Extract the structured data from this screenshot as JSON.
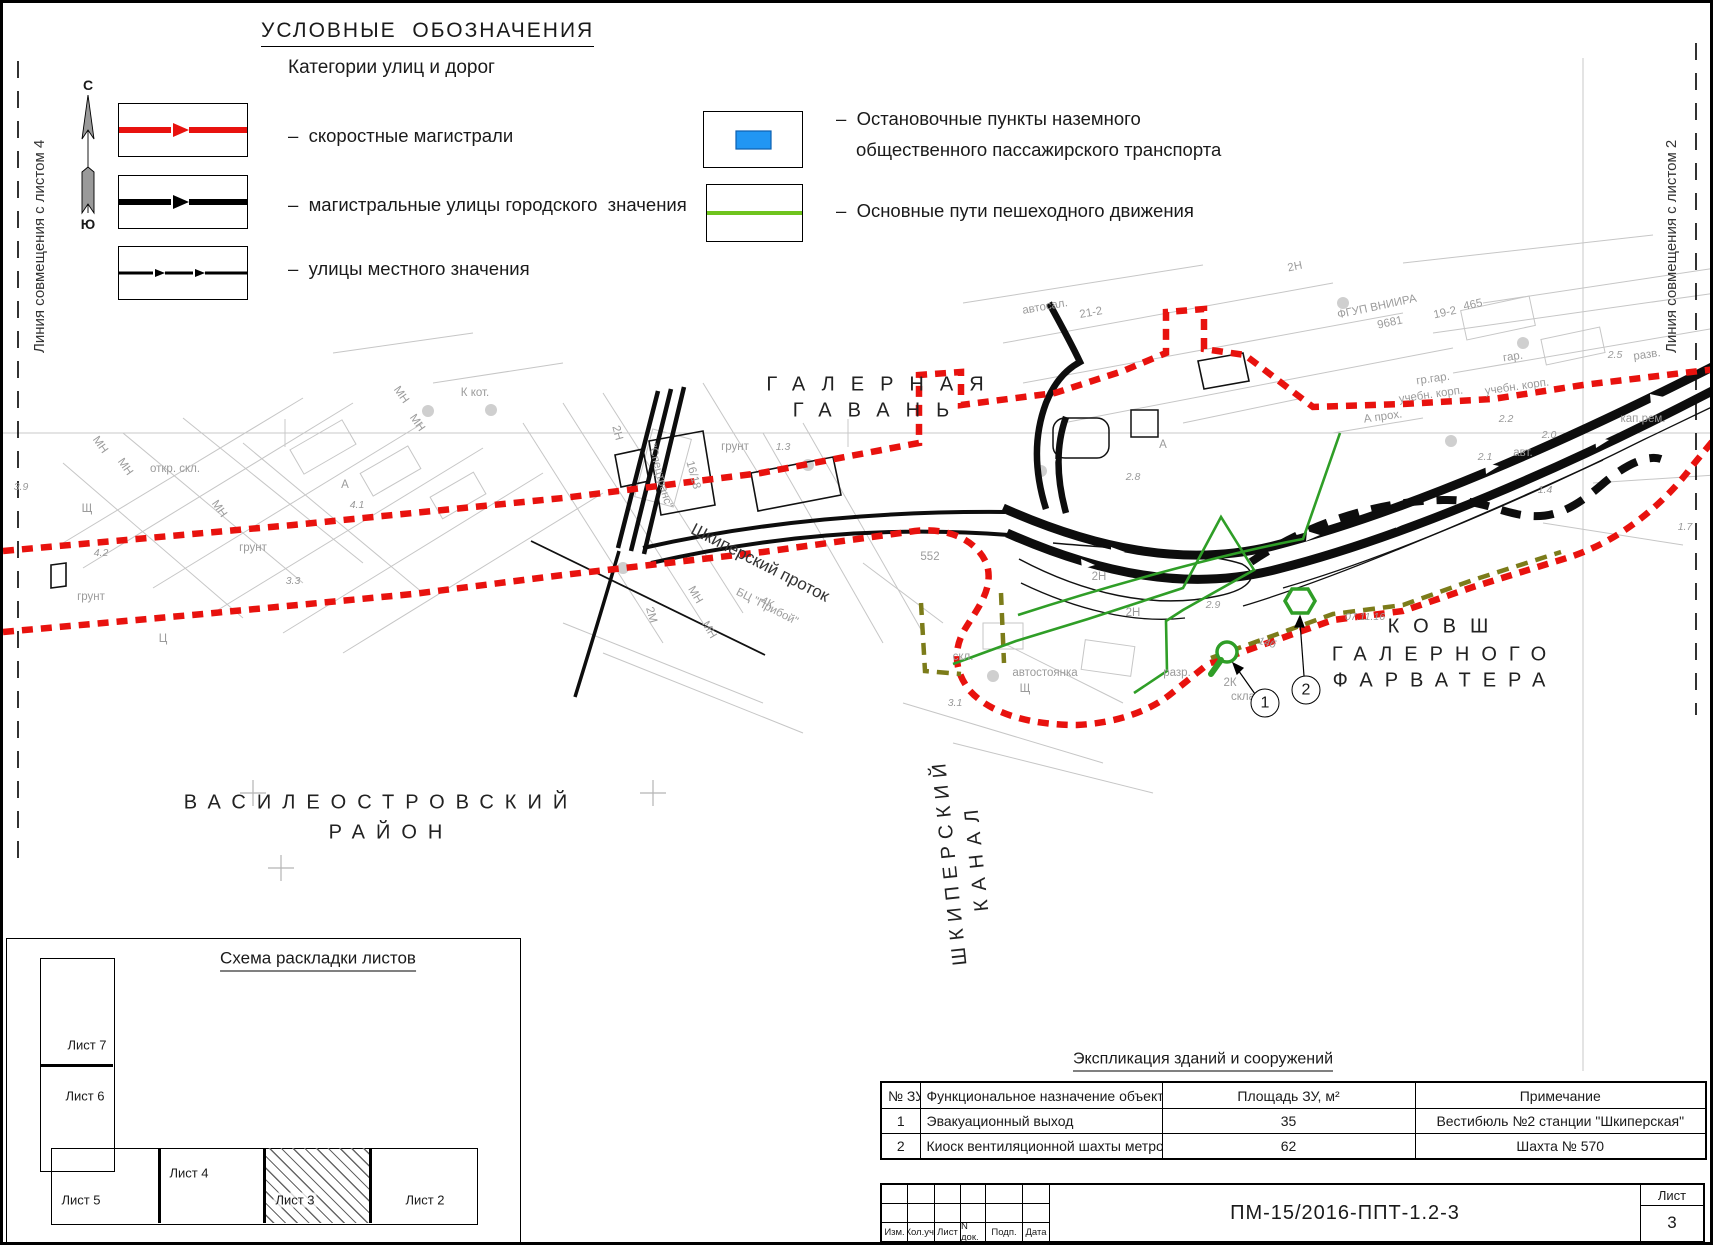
{
  "legend": {
    "title": "УСЛОВНЫЕ  ОБОЗНАЧЕНИЯ",
    "subtitle": "Категории улиц и дорог",
    "items": [
      {
        "label": "–  скоростные магистрали",
        "type": "red-line"
      },
      {
        "label": "–  магистральные улицы городского  значения",
        "type": "black-line"
      },
      {
        "label": "–  улицы местного значения",
        "type": "thin-dash-line"
      },
      {
        "label": "–  Остановочные пункты наземного общественного пассажирского транспорта",
        "type": "blue-rect"
      },
      {
        "label": "–  Основные пути пешеходного движения",
        "type": "green-line"
      }
    ],
    "colors": {
      "red": "#e8120e",
      "black": "#000000",
      "blue": "#2196f3",
      "legend_green": "#6fc41e",
      "map_green": "#2f9e27",
      "olive": "#7c7c1a"
    }
  },
  "compass": {
    "north": "С",
    "south": "Ю"
  },
  "edges": {
    "left": "Линия совмещения с листом 4",
    "right": "Линия совмещения с листом 2"
  },
  "map_labels": [
    {
      "t": "ГАЛЕРНАЯ",
      "x": 880,
      "y": 382,
      "c": "big",
      "ls": 16
    },
    {
      "t": "ГАВАНЬ",
      "x": 876,
      "y": 408,
      "c": "big",
      "ls": 16
    },
    {
      "t": "ВАСИЛЕОСТРОВСКИЙ",
      "x": 378,
      "y": 800,
      "c": "big",
      "ls": 11
    },
    {
      "t": "РАЙОН",
      "x": 388,
      "y": 830,
      "c": "big",
      "ls": 11
    },
    {
      "t": "КОВШ",
      "x": 1442,
      "y": 624,
      "c": "big",
      "ls": 14
    },
    {
      "t": "ГАЛЕРНОГО",
      "x": 1442,
      "y": 652,
      "c": "big",
      "ls": 12
    },
    {
      "t": "ФАРВАТЕРА",
      "x": 1442,
      "y": 678,
      "c": "big",
      "ls": 12
    },
    {
      "t": "ШКИПЕРСКИЙ",
      "x": 947,
      "y": 858,
      "c": "big vert",
      "r": 174,
      "ls": 7
    },
    {
      "t": "КАНАЛ",
      "x": 974,
      "y": 853,
      "c": "big vert",
      "r": 174,
      "ls": 9
    },
    {
      "t": "Шкиперский проток",
      "x": 757,
      "y": 560,
      "c": "med",
      "r": 27
    },
    {
      "t": "грунт",
      "x": 250,
      "y": 545,
      "c": "topo"
    },
    {
      "t": "грунт",
      "x": 88,
      "y": 594,
      "c": "topo"
    },
    {
      "t": "грунт",
      "x": 732,
      "y": 444,
      "c": "topo"
    },
    {
      "t": "откр. скл.",
      "x": 172,
      "y": 466,
      "c": "topo"
    },
    {
      "t": "Щ",
      "x": 84,
      "y": 506,
      "c": "topo"
    },
    {
      "t": "Щ",
      "x": 1022,
      "y": 686,
      "c": "topo"
    },
    {
      "t": "Ц",
      "x": 160,
      "y": 636,
      "c": "topo"
    },
    {
      "t": "МН",
      "x": 97,
      "y": 442,
      "c": "topo",
      "r": 55
    },
    {
      "t": "МН",
      "x": 122,
      "y": 464,
      "c": "topo",
      "r": 55
    },
    {
      "t": "МН",
      "x": 216,
      "y": 506,
      "c": "topo",
      "r": 55
    },
    {
      "t": "МН",
      "x": 398,
      "y": 392,
      "c": "topo",
      "r": 55
    },
    {
      "t": "МН",
      "x": 414,
      "y": 420,
      "c": "topo",
      "r": 55
    },
    {
      "t": "МН",
      "x": 692,
      "y": 592,
      "c": "topo",
      "r": 60
    },
    {
      "t": "МН",
      "x": 706,
      "y": 627,
      "c": "topo",
      "r": 60
    },
    {
      "t": "2Н",
      "x": 614,
      "y": 430,
      "c": "topo",
      "r": 75
    },
    {
      "t": "\"Спецтранс\"",
      "x": 657,
      "y": 473,
      "c": "topo",
      "r": 75
    },
    {
      "t": "16/18",
      "x": 690,
      "y": 472,
      "c": "topo",
      "r": 75
    },
    {
      "t": "К  кот.",
      "x": 472,
      "y": 390,
      "c": "topo"
    },
    {
      "t": "БЦ \"Прибой\"",
      "x": 764,
      "y": 604,
      "c": "topo",
      "r": 27
    },
    {
      "t": "2М",
      "x": 648,
      "y": 612,
      "c": "topo",
      "r": 75
    },
    {
      "t": "4К",
      "x": 764,
      "y": 600,
      "c": "topo",
      "r": 27
    },
    {
      "t": "А",
      "x": 342,
      "y": 482,
      "c": "topo"
    },
    {
      "t": "А",
      "x": 1160,
      "y": 442,
      "c": "topo"
    },
    {
      "t": "разр.",
      "x": 1174,
      "y": 670,
      "c": "topo"
    },
    {
      "t": "2К",
      "x": 1227,
      "y": 680,
      "c": "topo"
    },
    {
      "t": "скла",
      "x": 1240,
      "y": 694,
      "c": "topo"
    },
    {
      "t": "2Н",
      "x": 1096,
      "y": 574,
      "c": "topo"
    },
    {
      "t": "2Н",
      "x": 1130,
      "y": 610,
      "c": "topo"
    },
    {
      "t": "автостоянка",
      "x": 1042,
      "y": 670,
      "c": "topo"
    },
    {
      "t": "скл.",
      "x": 960,
      "y": 654,
      "c": "topo"
    },
    {
      "t": "552",
      "x": 927,
      "y": 554,
      "c": "topo"
    },
    {
      "t": "14б",
      "x": 1264,
      "y": 640,
      "c": "num",
      "r": 15
    },
    {
      "t": "07.11.16",
      "x": 1362,
      "y": 614,
      "c": "num"
    },
    {
      "t": "ФГУП ВНИИРА",
      "x": 1374,
      "y": 304,
      "c": "topo",
      "r": -12
    },
    {
      "t": "9681",
      "x": 1387,
      "y": 320,
      "c": "topo",
      "r": -12
    },
    {
      "t": "19-2",
      "x": 1442,
      "y": 310,
      "c": "topo",
      "r": -12
    },
    {
      "t": "465",
      "x": 1470,
      "y": 302,
      "c": "topo",
      "r": -12
    },
    {
      "t": "2Н",
      "x": 1292,
      "y": 264,
      "c": "topo",
      "r": -12
    },
    {
      "t": "автосал.",
      "x": 1042,
      "y": 304,
      "c": "topo",
      "r": -10
    },
    {
      "t": "21-2",
      "x": 1088,
      "y": 310,
      "c": "topo",
      "r": -10
    },
    {
      "t": "гр.гар.",
      "x": 1430,
      "y": 376,
      "c": "topo",
      "r": -8
    },
    {
      "t": "гар.",
      "x": 1510,
      "y": 354,
      "c": "topo",
      "r": -8
    },
    {
      "t": "разв.",
      "x": 1644,
      "y": 352,
      "c": "topo",
      "r": -8
    },
    {
      "t": "учебн. корп.",
      "x": 1428,
      "y": 392,
      "c": "topo",
      "r": -8
    },
    {
      "t": "учебн. корп.",
      "x": 1514,
      "y": 384,
      "c": "topo",
      "r": -8
    },
    {
      "t": "А прох.",
      "x": 1380,
      "y": 414,
      "c": "topo",
      "r": -8
    },
    {
      "t": "кап.рем.",
      "x": 1640,
      "y": 416,
      "c": "topo"
    },
    {
      "t": "авт.",
      "x": 1520,
      "y": 450,
      "c": "topo"
    },
    {
      "t": "1.3",
      "x": 780,
      "y": 444,
      "c": "num"
    },
    {
      "t": "4.1",
      "x": 354,
      "y": 502,
      "c": "num"
    },
    {
      "t": "4.2",
      "x": 98,
      "y": 550,
      "c": "num"
    },
    {
      "t": "3.3",
      "x": 290,
      "y": 578,
      "c": "num"
    },
    {
      "t": "3.9",
      "x": 18,
      "y": 484,
      "c": "num"
    },
    {
      "t": "2.9",
      "x": 1210,
      "y": 602,
      "c": "num"
    },
    {
      "t": "2.8",
      "x": 1130,
      "y": 474,
      "c": "num"
    },
    {
      "t": "2.0",
      "x": 1546,
      "y": 432,
      "c": "num"
    },
    {
      "t": "2.1",
      "x": 1482,
      "y": 454,
      "c": "num"
    },
    {
      "t": "2.2",
      "x": 1503,
      "y": 416,
      "c": "num"
    },
    {
      "t": "1.4",
      "x": 1542,
      "y": 487,
      "c": "num"
    },
    {
      "t": "1.7",
      "x": 1682,
      "y": 524,
      "c": "num"
    },
    {
      "t": "3.1",
      "x": 952,
      "y": 700,
      "c": "num"
    },
    {
      "t": "2.5",
      "x": 1612,
      "y": 352,
      "c": "num"
    }
  ],
  "callouts": [
    {
      "n": "1"
    },
    {
      "n": "2"
    }
  ],
  "scheme": {
    "title": "Схема раскладки листов",
    "sheets": [
      "Лист 7",
      "Лист 6",
      "Лист 5",
      "Лист 4",
      "Лист 3",
      "Лист 2"
    ],
    "current": "Лист 3"
  },
  "explication": {
    "title": "Экспликация зданий и сооружений",
    "columns": [
      "№ ЗУ",
      "Функциональное назначение объекта",
      "Площадь ЗУ, м²",
      "Примечание"
    ],
    "rows": [
      [
        "1",
        "Эвакуационный выход",
        "35",
        "Вестибюль №2 станции \"Шкиперская\""
      ],
      [
        "2",
        "Киоск вентиляционной шахты метрополитена",
        "62",
        "Шахта № 570"
      ]
    ]
  },
  "titleblock": {
    "cells": [
      "Изм.",
      "Кол.уч.",
      "Лист",
      "N док.",
      "Подп.",
      "Дата"
    ],
    "code": "ПМ-15/2016-ППТ-1.2-3",
    "sheet_label": "Лист",
    "sheet_number": "3"
  }
}
